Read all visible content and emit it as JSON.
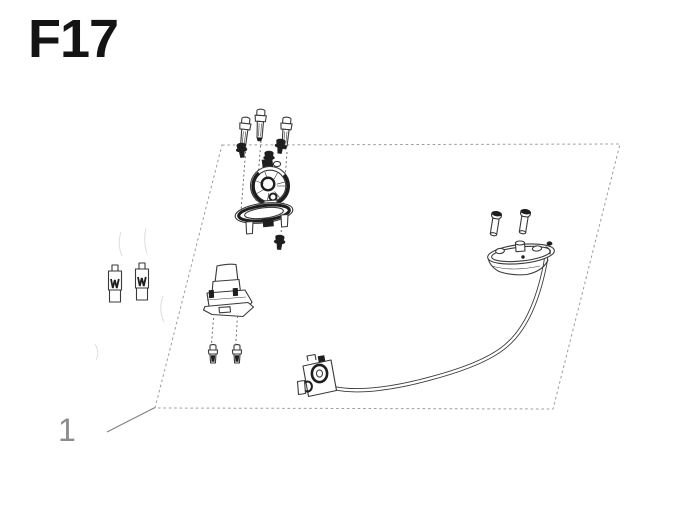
{
  "title": "F17",
  "callout": {
    "label": "1"
  },
  "colors": {
    "background": "#ffffff",
    "title": "#141414",
    "line": "#3a3a3a",
    "dark": "#1e1e1e",
    "boundary": "#9c9c9c",
    "callout": "#8c8c8c",
    "dash": "#5f5f5f"
  },
  "parts": [
    {
      "id": "diagram-boundary"
    },
    {
      "id": "mounting-bolt-long",
      "count": 3
    },
    {
      "id": "flange-screw-short",
      "count": 4
    },
    {
      "id": "fuel-pump-module",
      "count": 1
    },
    {
      "id": "pump-mounting-flange",
      "count": 1
    },
    {
      "id": "rubber-grommet",
      "count": 2
    },
    {
      "id": "ignition-lock-assembly",
      "count": 1
    },
    {
      "id": "bracket-screw",
      "count": 2
    },
    {
      "id": "sender-screw",
      "count": 2
    },
    {
      "id": "fuel-sender-unit",
      "count": 1
    },
    {
      "id": "sender-cable",
      "count": 1
    },
    {
      "id": "cable-connector",
      "count": 1
    }
  ]
}
